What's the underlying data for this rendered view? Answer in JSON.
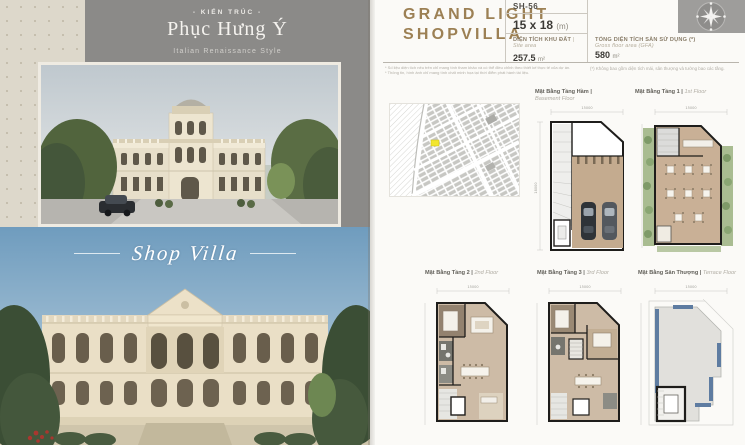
{
  "left_page": {
    "arch": {
      "eyebrow": "- KIẾN TRÚC -",
      "title": "Phục Hưng Ý",
      "subtitle": "Italian Renaissance Style"
    },
    "caption": "Shop Villa"
  },
  "right_page": {
    "title_line1": "GRAND LIGHT",
    "title_line2": "SHOPVILLA",
    "unit_code": "SH-56",
    "size": {
      "value": "15 x 18",
      "unit": "(m)"
    },
    "site_area": {
      "label_vi": "DIỆN TÍCH KHU ĐẤT",
      "label_en": "| Site area",
      "value": "257.5",
      "unit": "m²"
    },
    "gfa": {
      "label_vi": "TỔNG DIỆN TÍCH SÀN SỬ DỤNG (*)",
      "label_en": "Gross floor area (GFA)",
      "value": "580",
      "unit": "m²"
    },
    "footnotes": {
      "left_line1": "* Số liệu diện tích nêu trên chỉ mang tính tham khảo và có thể điều chỉnh theo thiết kế thực tế của dự án.",
      "left_line2": "* Thông tin, hình ảnh chỉ mang tính chất minh họa tại thời điểm phát hành tài liệu.",
      "right": "(*) Không bao gồm diện tích mái, sân thượng và tường bao các tầng."
    },
    "floor_plans": [
      {
        "vi": "Mặt Bằng Tầng Hầm |",
        "en": "Basement Floor"
      },
      {
        "vi": "Mặt Bằng Tầng 1 |",
        "en": "1st Floor"
      },
      {
        "vi": "Mặt Bằng Tầng 2 |",
        "en": "2nd Floor"
      },
      {
        "vi": "Mặt Bằng Tầng 3 |",
        "en": "3rd Floor"
      },
      {
        "vi": "Mặt Bằng Sân Thượng |",
        "en": "Terrace Floor"
      }
    ],
    "plan_dims": {
      "width": "15000",
      "depth": "18000"
    },
    "icons": {
      "compass": "compass-rose"
    }
  },
  "colors": {
    "title_gold": "#9c8054",
    "panel_gray": "#8b8a88",
    "floor_tan": "#c9b197",
    "highlight_lot": "#f2e62e",
    "terrace_blue": "#5e7ca1"
  }
}
